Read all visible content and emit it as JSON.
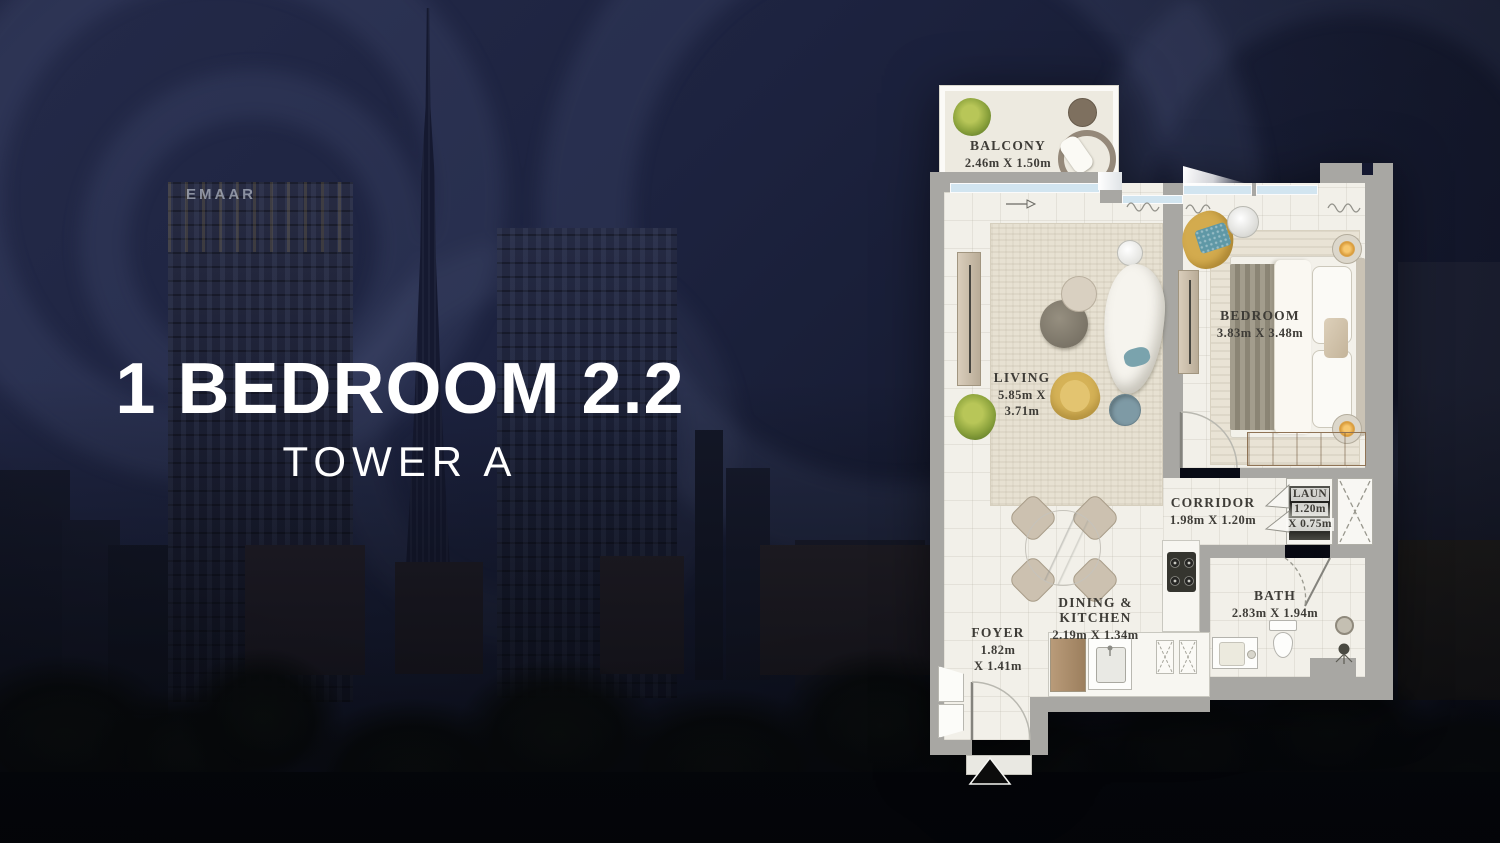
{
  "title": {
    "line1": "1 BEDROOM 2.2",
    "line2": "TOWER A"
  },
  "skyline": {
    "logo": "EMAAR"
  },
  "floor_plan": {
    "rooms": {
      "balcony": {
        "name": "BALCONY",
        "dims": "2.46m X 1.50m"
      },
      "living": {
        "name": "LIVING",
        "dims_line1": "5.85m X",
        "dims_line2": "3.71m"
      },
      "bedroom": {
        "name": "BEDROOM",
        "dims": "3.83m X 3.48m"
      },
      "corridor": {
        "name": "CORRIDOR",
        "dims": "1.98m X 1.20m"
      },
      "laundry": {
        "name": "LAUN",
        "dims_line1": "1.20m",
        "dims_line2": "X 0.75m"
      },
      "dining_kitchen": {
        "name": "DINING & KITCHEN",
        "dims": "2.19m X 1.34m"
      },
      "bath": {
        "name": "BATH",
        "dims": "2.83m X 1.94m"
      },
      "foyer": {
        "name": "FOYER",
        "dims_line1": "1.82m",
        "dims_line2": "X 1.41m"
      }
    },
    "colors": {
      "wall": "#a8a7a3",
      "floor": "#f2f0e9",
      "window_glass": "#d2e5f0",
      "label_text": "#3e3c37",
      "wood": "#c0a887",
      "accent_yellow": "#d3ab4e",
      "accent_teal": "#6f9da9",
      "plant_green": "#8ba23c",
      "background_navy": "#1b2038"
    }
  }
}
